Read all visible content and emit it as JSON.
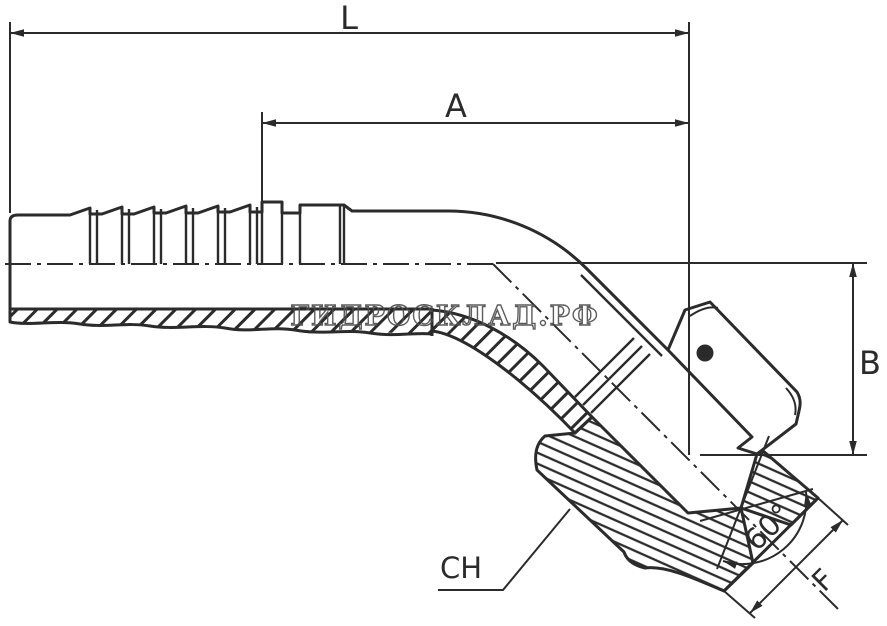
{
  "colors": {
    "background": "#ffffff",
    "line": "#2b2b2b",
    "watermark": "#4f4f4f"
  },
  "watermark": {
    "text": "ГИДРОСКЛАД.РФ"
  },
  "annotations": {
    "dim_overall_length": "L",
    "dim_tail_length": "A",
    "dim_drop_height": "B",
    "cone_angle": "60°",
    "hex_wrench_size": "CH",
    "seat_flat": "F"
  }
}
